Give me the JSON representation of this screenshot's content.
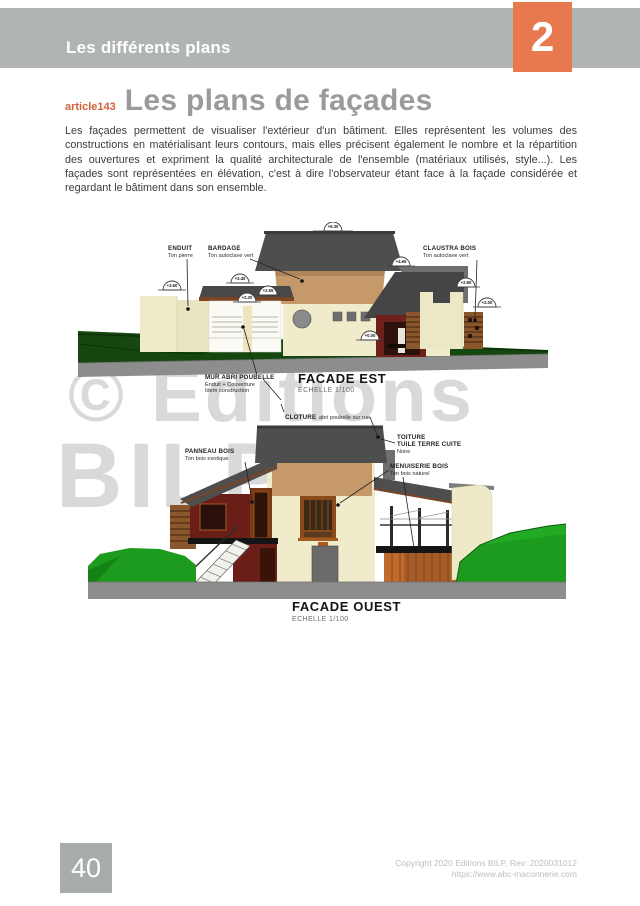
{
  "header": {
    "chapter_title": "Les différents plans",
    "chapter_number": "2"
  },
  "article": {
    "id": "article143",
    "title": "Les plans de façades",
    "body": "Les façades permettent de visualiser l'extérieur d'un bâtiment. Elles représentent les volumes des constructions en matérialisant leurs contours, mais elles précisent également le nombre et la répartition des ouvertures et expriment la qualité architecturale de l'ensemble (matériaux utilisés, style...). Les façades sont représentées en élévation, c'est à dire l'observateur étant face à la façade considérée et regardant le bâtiment dans son ensemble."
  },
  "watermark": {
    "line1": "© Editions",
    "line2": "BILP"
  },
  "facade_est": {
    "title": "FACADE EST",
    "scale": "ECHELLE 1/100",
    "labels": {
      "enduit": {
        "line1": "ENDUIT",
        "line2": "Ton pierre"
      },
      "bardage": {
        "line1": "BARDAGE",
        "line2": "Ton autoclave vert"
      },
      "claustra": {
        "line1": "CLAUSTRA BOIS",
        "line2": "Ton autoclave vert"
      },
      "mur_abri": {
        "line1": "MUR ABRI POUBELLE",
        "line2": "Enduit + Couverture",
        "line3": "Idem construction"
      }
    },
    "elevations": [
      "+3.60",
      "+2.40",
      "+2.30",
      "+2.55",
      "+6.30",
      "+4.65",
      "+2.80",
      "+2.00",
      "+0.00"
    ]
  },
  "facade_ouest": {
    "title": "FACADE OUEST",
    "scale": "ECHELLE 1/100",
    "labels": {
      "cloture": {
        "line1": "CLOTURE",
        "line2": "abri poubelle sur rue"
      },
      "toiture": {
        "line1": "TOITURE",
        "line2": "TUILE TERRE CUITE",
        "line3": "Noire"
      },
      "panneau": {
        "line1": "PANNEAU BOIS",
        "line2": "Ton bois exotique"
      },
      "menuiserie": {
        "line1": "MENUISERIE BOIS",
        "line2": "Ton bois naturel"
      }
    }
  },
  "footer": {
    "page_number": "40",
    "copyright_line1": "Copyright 2020 Editions BILP, Rev: 2020031012",
    "copyright_line2": "https://www.abc-maconnerie.com"
  },
  "colors": {
    "accent_orange": "#e8794f",
    "header_gray": "#b1b5b1",
    "title_gray": "#9a9a9a",
    "footer_gray": "#a9ada9",
    "roof_dark": "#4e4e4e",
    "wall_cream": "#f0ebca",
    "bardage_tan": "#c6996a",
    "wood_red": "#6b1e18",
    "claustra_wood": "#8a562b",
    "terracotta": "#a55c28",
    "grass_green": "#1c9b1e",
    "terrain_dark_green": "#15470f",
    "ground_gray": "#8d8d8d",
    "watermark_gray": "#d9d9d9"
  }
}
